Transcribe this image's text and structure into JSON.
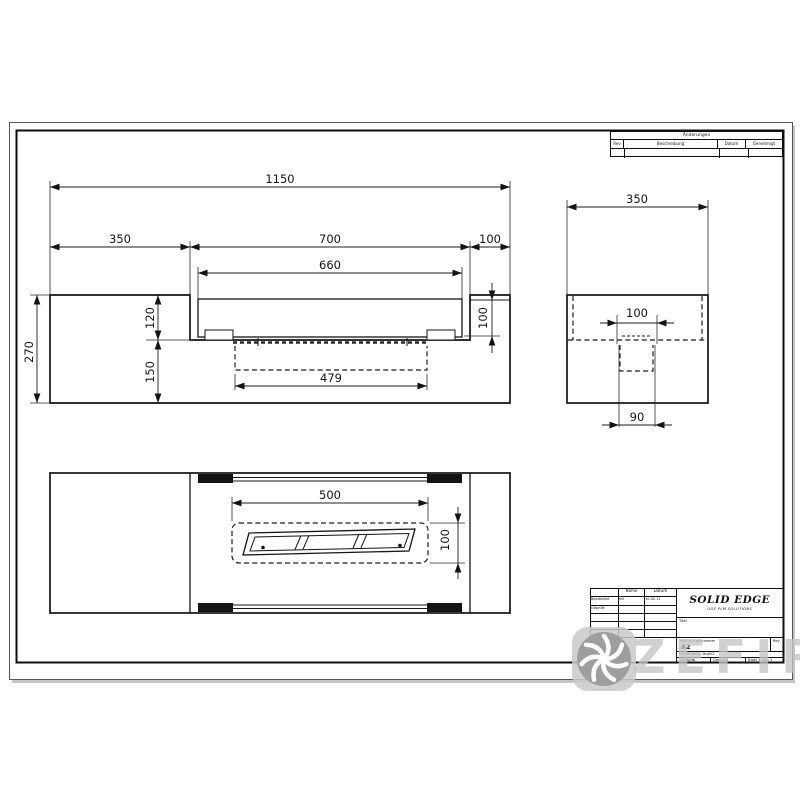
{
  "drawing": {
    "dims": {
      "front": {
        "overall": "1150",
        "left_section": "350",
        "opening": "700",
        "right_section": "100",
        "tray_width": "660",
        "height": "270",
        "upper_depth": "120",
        "lower_depth": "150",
        "right_depth": "100",
        "hidden_width": "479"
      },
      "side": {
        "overall": "350",
        "slot": "100",
        "pot": "90"
      },
      "plan": {
        "burner_length": "500",
        "burner_depth": "100"
      }
    }
  },
  "revision_table": {
    "title": "Änderungen",
    "col_rev": "Rev",
    "col_description": "Beschreibung",
    "col_date": "Datum",
    "col_approved": "Genehmigt"
  },
  "title_block": {
    "col_name": "Name",
    "col_date": "Datum",
    "row_edited_label": "Bearbeitet",
    "row_edited_name": "mk",
    "row_edited_date": "10.02.11",
    "row_checked_label": "Geprüft",
    "logo": "SOLID EDGE",
    "logo_subtitle": "UGS PLM SOLUTIONS",
    "title_label": "Titel",
    "drawing_number_label": "Zeichnungsnummer",
    "drawing_number": "A2",
    "rev_label": "Rev",
    "filename": "Dateiname: Draft1",
    "scale_label": "Maßstab",
    "weight_label": "Gewicht",
    "sheet_label": "Blatt 1 von 1"
  },
  "watermark": {
    "text": "ZEFIRE"
  }
}
